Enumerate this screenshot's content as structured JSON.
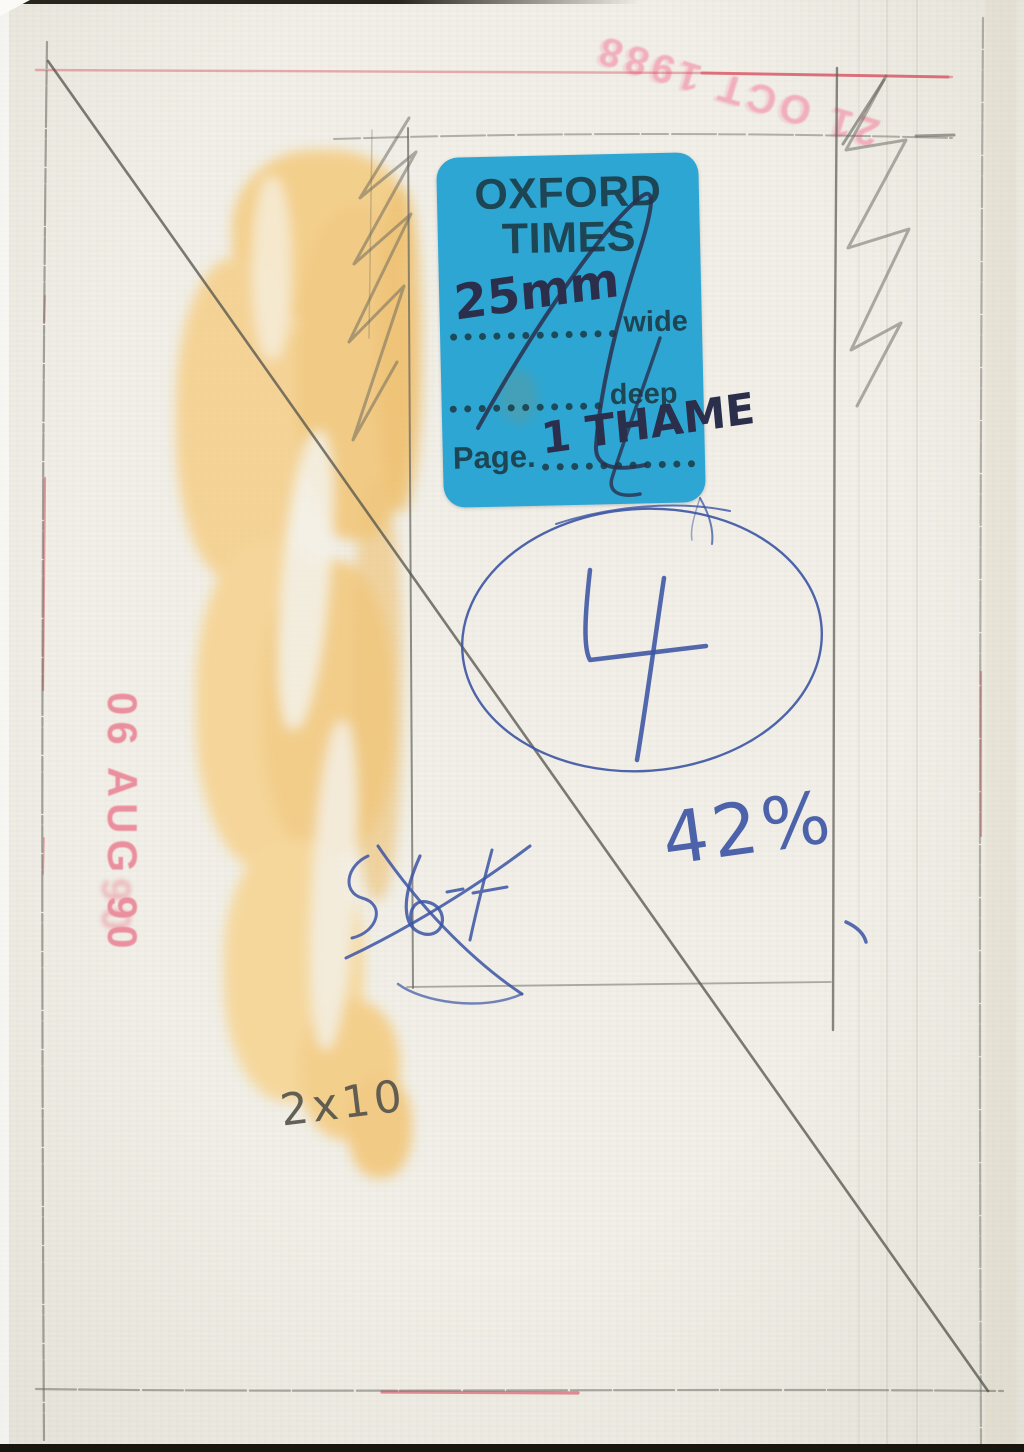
{
  "sticker": {
    "title_line1": "OXFORD",
    "title_line2": "TIMES",
    "wide_value": "25mm",
    "wide_label": "wide",
    "deep_label": "deep",
    "page_label": "Page.",
    "page_value": "1 THAME"
  },
  "stamps": {
    "top_right": {
      "text": "21 OCT 1988"
    },
    "left": {
      "text": "06 AUG 90",
      "smudge": "90"
    }
  },
  "annotations": {
    "circled_number": "4",
    "percentage": "42%",
    "size_note": "2x10",
    "price_scribble": "$6"
  },
  "colors": {
    "paper": "#f1efe7",
    "sticker-blue": "#2da6d3",
    "sticker-ink": "#1d4553",
    "marker-navy": "#2b2f4c",
    "pen-blue": "#3b54a4",
    "stamp-red": "#ea7f92",
    "stamp-pink": "#f2a0b2",
    "red-line": "#d95565",
    "pencil": "#63635b",
    "pencil-dark": "#52524b",
    "paint-yellow": "#f4cd86"
  }
}
